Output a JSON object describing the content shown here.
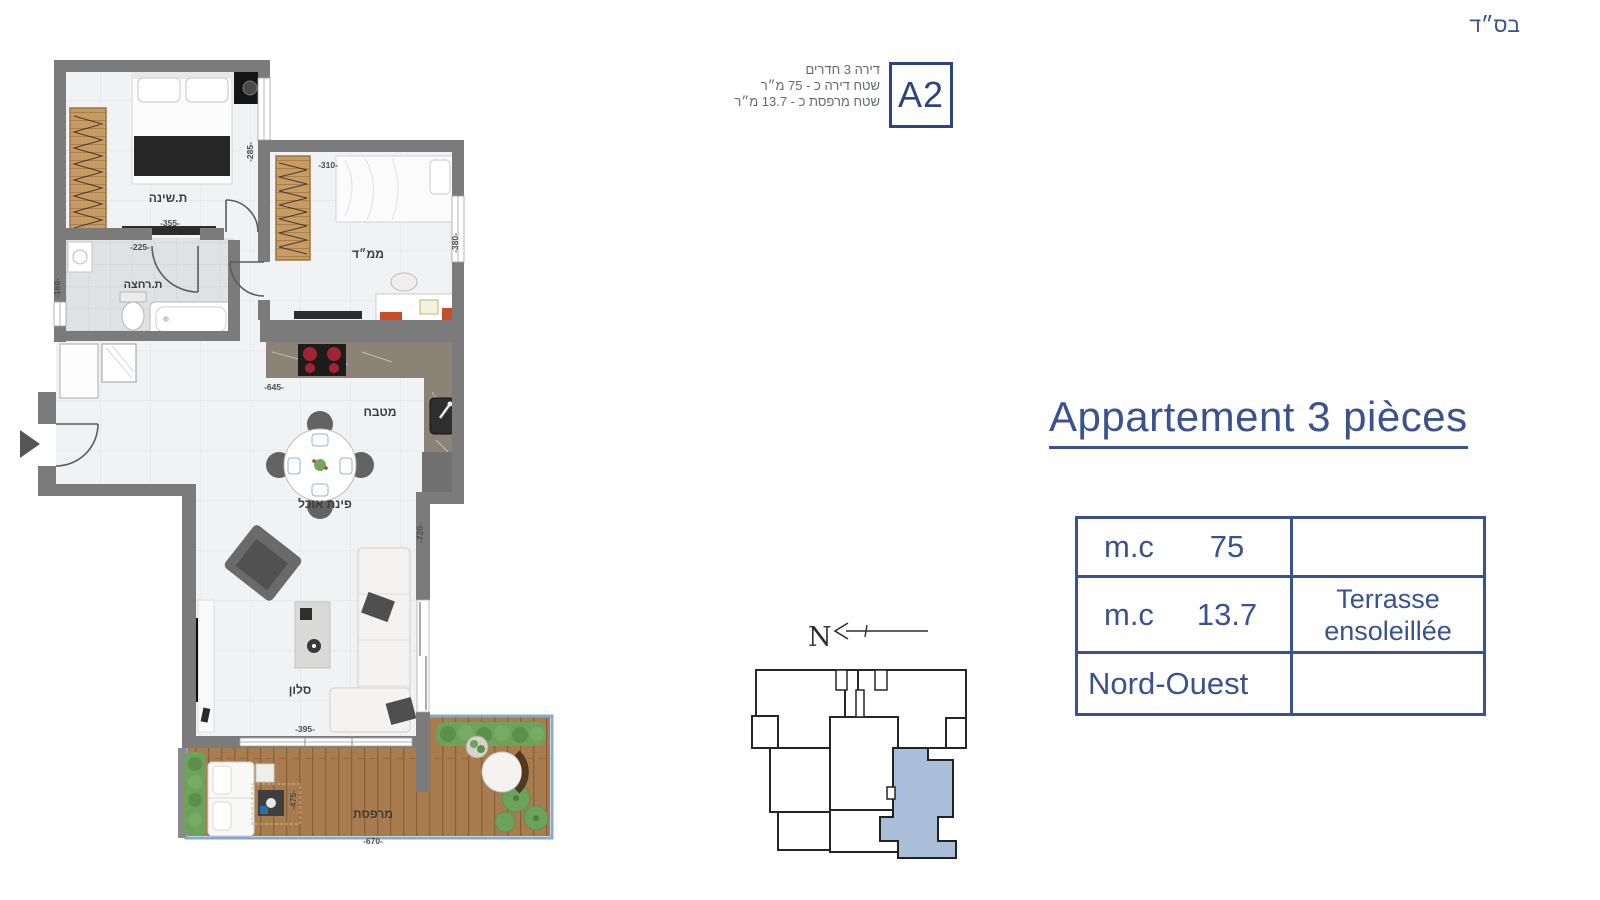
{
  "bsd": "בס״ד",
  "header": {
    "line1": "דירה 3 חדרים",
    "line2": "שטח דירה כ - 75 מ״ר",
    "line3": "שטח מרפסת כ - 13.7 מ״ר",
    "unit": "A2"
  },
  "title": "Appartement 3 pièces",
  "table": {
    "row1": {
      "label": "m.c",
      "value": "75"
    },
    "row2": {
      "label": "m.c",
      "value": "13.7",
      "note_line1": "Terrasse",
      "note_line2": "ensoleillée"
    },
    "row3": {
      "label": "Nord-Ouest"
    }
  },
  "plan": {
    "rooms": {
      "bedroom": "ת.שינה",
      "mamad": "ממ״ד",
      "bathroom": "ת.רחצה",
      "kitchen": "מטבח",
      "dining": "פינת אוכל",
      "living": "סלון",
      "terrace": "מרפסת"
    },
    "dims": {
      "bedroom_w": "-355-",
      "bedroom_h": "-285-",
      "mamad_w": "-310-",
      "mamad_h": "-380-",
      "bathroom_w": "-225-",
      "bathroom_h": "-160-",
      "kitchen_w": "-645-",
      "living_w": "-395-",
      "living_h": "-720-",
      "terrace_w": "-670-",
      "terrace_h": "-475-"
    }
  },
  "keyplan": {
    "north": "N"
  },
  "colors": {
    "accent": "#3b5190",
    "wall": "#7b7b7b",
    "unit_highlight": "#a9bed8",
    "deck": "#a87c4f"
  }
}
